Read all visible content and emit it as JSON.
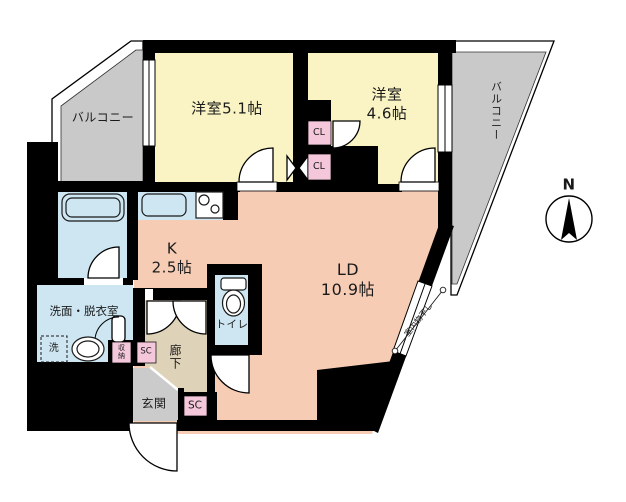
{
  "plan_title": "2LDK floor plan",
  "colors": {
    "wall": "#000000",
    "bedroom_fill": "#faf4c4",
    "living_fill": "#f7ccb4",
    "wet_area_fill": "#cde6f2",
    "balcony_fill": "#c9c9c9",
    "entrance_fill": "#cbcbcb",
    "hallway_fill": "#ded2b8",
    "closet_fill": "#f4c7da"
  },
  "rooms": {
    "bedroom1": {
      "label": "洋室5.1帖"
    },
    "bedroom2": {
      "label": "洋室\n4.6帖"
    },
    "living_dining": {
      "label": "LD\n10.9帖"
    },
    "kitchen": {
      "label": "K\n2.5帖"
    },
    "washroom": {
      "label": "洗面・脱衣室"
    },
    "toilet": {
      "label": "トイレ"
    },
    "hallway": {
      "label": "廊下"
    },
    "entrance": {
      "label": "玄関"
    },
    "balcony_left": {
      "label": "バルコニー"
    },
    "balcony_right": {
      "label": "バルコニー"
    },
    "closet1": {
      "label": "CL"
    },
    "closet2": {
      "label": "CL"
    },
    "shoe_closet1": {
      "label": "SC"
    },
    "shoe_closet2": {
      "label": "SC"
    },
    "storage": {
      "label": "収納"
    },
    "laundry_space": {
      "label": "洗"
    },
    "indoor_drying": {
      "label": "室内物干し"
    }
  },
  "compass": {
    "label": "N"
  }
}
